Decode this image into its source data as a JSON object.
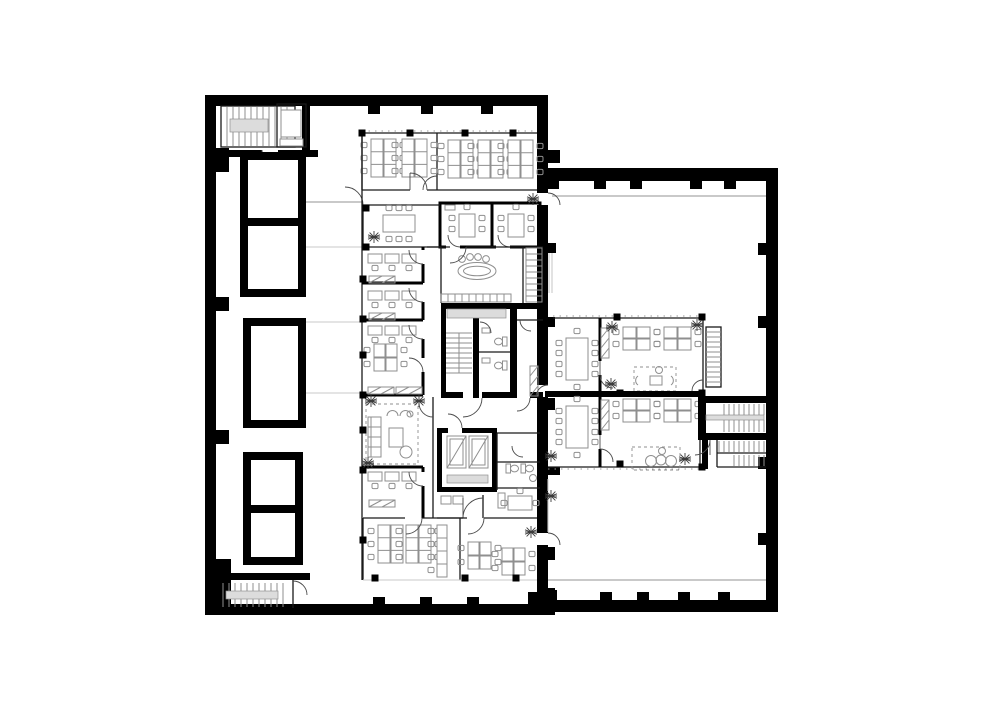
{
  "meta": {
    "description": "Black and white architectural floor plan of an L-shaped office building with a west wing and an east wing, drawn in top-down view with no text labels",
    "drawing_type": "architectural floor plan",
    "view": "top-down",
    "visible_text": "none"
  },
  "colors": {
    "background": "#ffffff",
    "wall": "#000000",
    "furniture": "#8f8f8f",
    "light_line": "#c9c9c9",
    "gray_fill": "#dcdcdc",
    "door": "#4a4a4a",
    "plant": "#3c3c3c",
    "thin": "#1a1a1a"
  },
  "features": {
    "west_wing": {
      "stairwells": [
        "northwest-stairwell",
        "southwest-stairwell",
        "core-stairwell"
      ],
      "elevator": "elevator",
      "voids": [
        "void-shaft-1",
        "void-shaft-2",
        "void-shaft-3"
      ],
      "rooms": [
        "open-office-north",
        "meeting-room-a",
        "meeting-room-b",
        "conference-room",
        "reception-standing-table",
        "cellular-office-1",
        "cellular-office-2",
        "cellular-office-3",
        "lounge",
        "cellular-office-4",
        "core-wc",
        "service-shafts",
        "kitchenette",
        "office-southeast",
        "open-office-south"
      ],
      "desk_groups": 8,
      "desk_clusters": 3,
      "plants": 6,
      "toilets": 6,
      "wardrobes": 5,
      "locker_rows": 1,
      "oval_tables": 1
    },
    "east_wing": {
      "stairwells": [
        "east-stair-block",
        "east-lower-stair",
        "suite-ladder-stair"
      ],
      "rooms": [
        "open-hall-north",
        "suite-north-meeting",
        "suite-north-office",
        "suite-north-lounge",
        "suite-south-meeting",
        "suite-south-office",
        "suite-south-lounge",
        "open-hall-south"
      ],
      "meeting_tables": 2,
      "desk_clusters": 4,
      "plants": 6,
      "column_dots": 8
    }
  }
}
